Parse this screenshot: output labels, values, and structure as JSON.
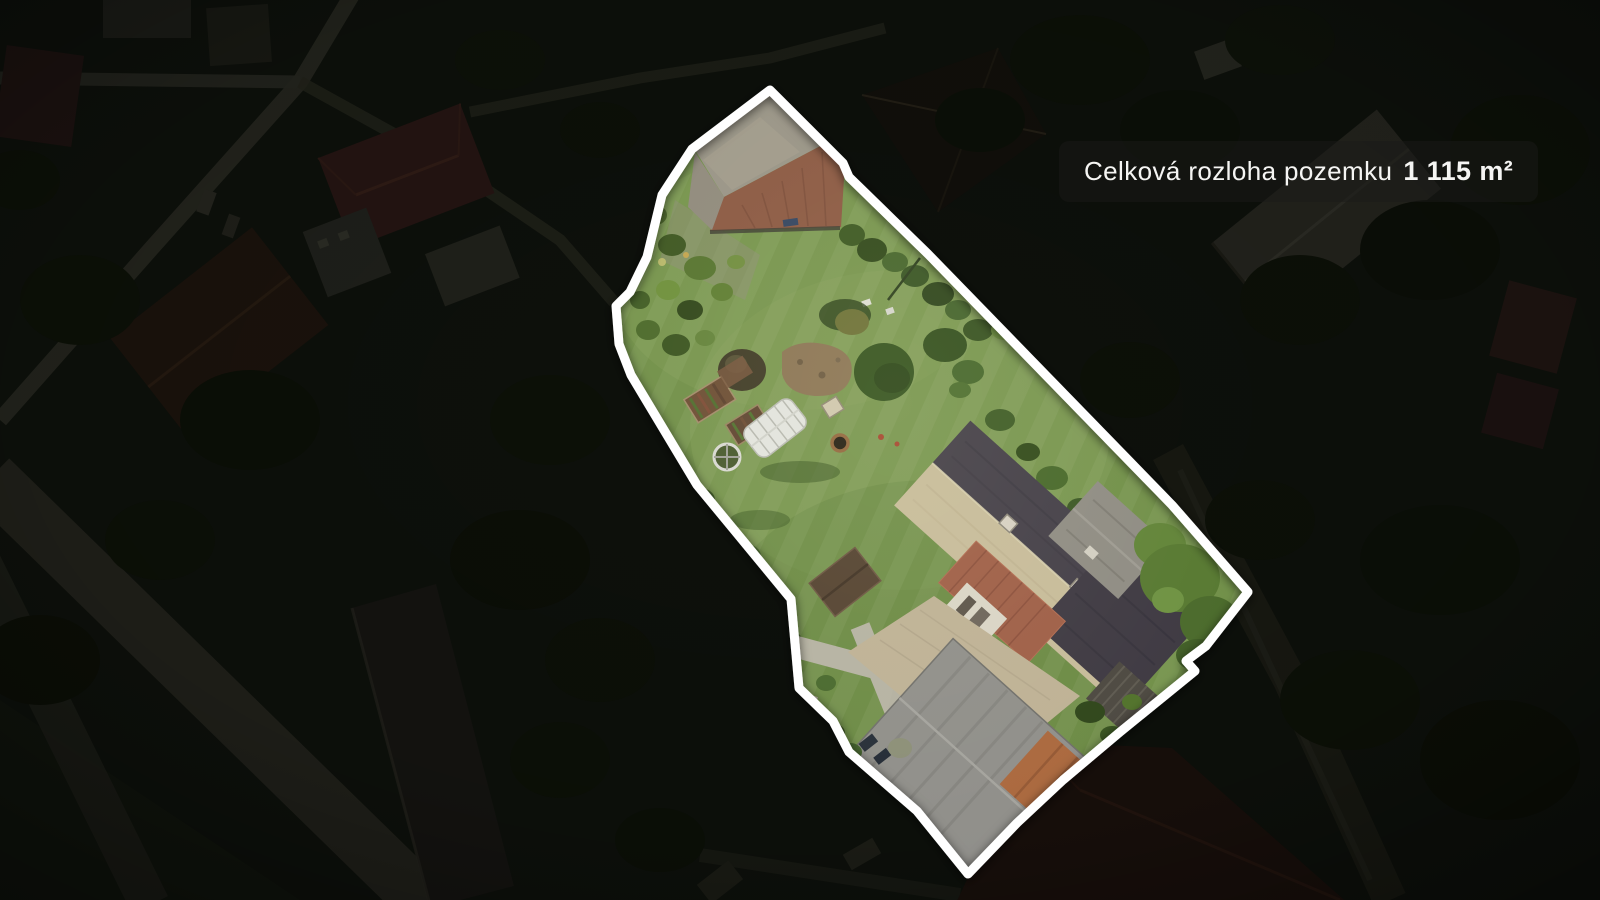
{
  "badge": {
    "label": "Celková rozloha pozemku",
    "value": "1 115 m²"
  },
  "colors": {
    "plot_outline": "#ffffff",
    "badge_background": "rgba(26,26,24,0.5)",
    "badge_text": "#f5f5f3",
    "lawn_green": "#6f8e47",
    "roof_beige": "#c6ba99",
    "roof_slate": "#413c46",
    "roof_red": "#9d5c45",
    "barn_roof_gray": "#989386",
    "barn_roof_red": "#8a5741",
    "surroundings_base": "#0d100b"
  }
}
